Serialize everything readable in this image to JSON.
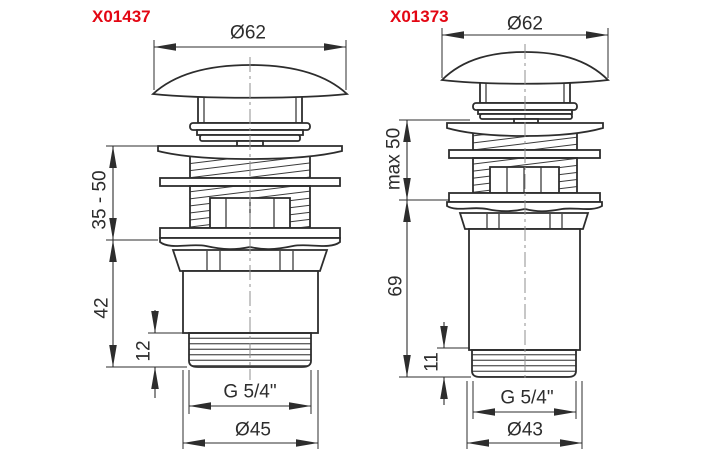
{
  "theme": {
    "background": "#ffffff",
    "line_color": "#2d2d2d",
    "accent_red": "#e30613",
    "centerline_color": "#8f8f8f"
  },
  "drawings": [
    {
      "part_number": "X01437",
      "dims": {
        "top_diameter": "Ø62",
        "mount_range": "35 - 50",
        "body_height": "42",
        "thread_length": "12",
        "thread_size": "G 5/4\"",
        "bottom_diameter": "Ø45"
      }
    },
    {
      "part_number": "X01373",
      "dims": {
        "top_diameter": "Ø62",
        "mount_range": "max 50",
        "body_height": "69",
        "thread_length": "11",
        "thread_size": "G 5/4\"",
        "bottom_diameter": "Ø43"
      }
    }
  ]
}
